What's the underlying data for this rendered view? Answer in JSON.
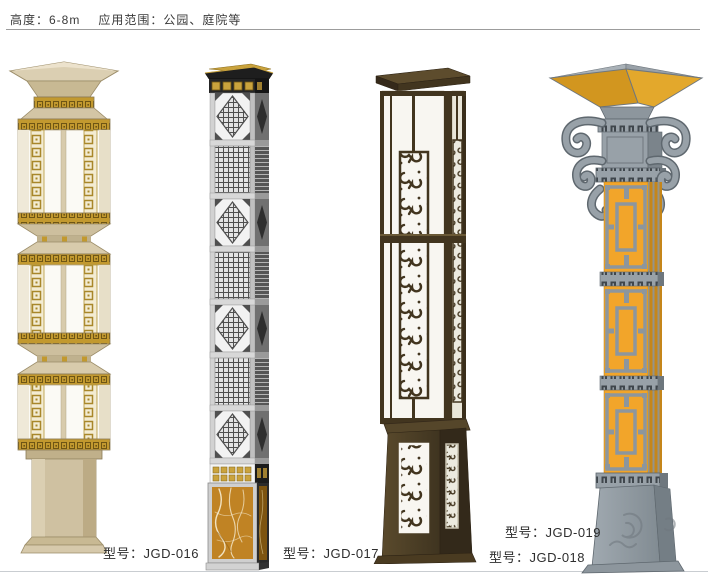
{
  "header": {
    "height_label": "高度：6-8m",
    "scope_label": "应用范围：公园、庭院等"
  },
  "products": [
    {
      "model_label": "型号：JGD-016"
    },
    {
      "model_label": "型号：JGD-017"
    },
    {
      "model_label": "型号：JGD-018"
    },
    {
      "model_label": "型号：JGD-019"
    }
  ],
  "colors": {
    "lamp1_body_beige": "#cfc1a1",
    "lamp1_gold_fret": "#c2992f",
    "lamp1_panel_white": "#fbfaf5",
    "lamp2_silver": "#c6c6c6",
    "lamp2_cap_black": "#1e1e1e",
    "lamp2_gold": "#caa33d",
    "lamp2_marble_amber": "#c08324",
    "lamp3_dark_brown": "#42351f",
    "lamp3_panel_white": "#f8f6f1",
    "lamp4_gray": "#98a1a8",
    "lamp4_amber_panel": "#f2a52a",
    "lamp4_canopy_glass": "#d2961f",
    "top_rule": "#9c9c9c",
    "bottom_rule": "#c9cdd1"
  }
}
